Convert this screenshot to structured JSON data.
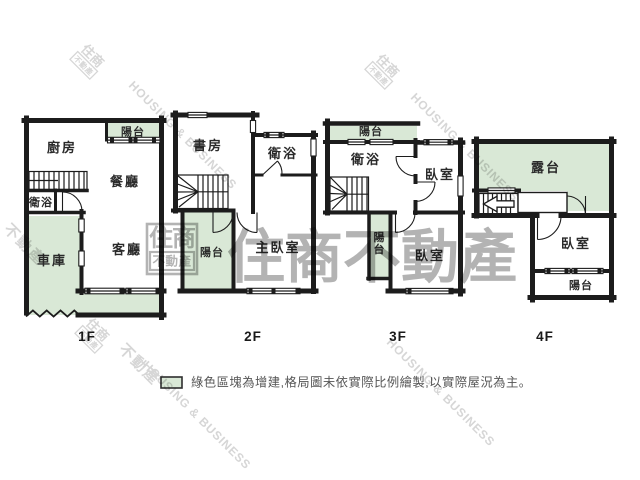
{
  "brand": {
    "logo_primary": "住商",
    "logo_secondary": "不動產",
    "name_cn": "住商不動產",
    "name_en": "HOUSING & BUSINESS"
  },
  "colors": {
    "addition_green": "#d9e8d6",
    "wall": "#1c1c1c",
    "watermark_center": "#b3b3b3",
    "watermark_diagonal": "#d6d6d6"
  },
  "floors": [
    {
      "label": "1F",
      "rooms": {
        "kitchen": "廚房",
        "balcony": "陽台",
        "dining": "餐廳",
        "bath": "衛浴",
        "living": "客廳",
        "garage": "車庫"
      }
    },
    {
      "label": "2F",
      "rooms": {
        "study": "書房",
        "bath": "衛浴",
        "balcony": "陽台",
        "master": "主臥室"
      }
    },
    {
      "label": "3F",
      "rooms": {
        "balcony_top": "陽台",
        "bath": "衛浴",
        "bedroom_top": "臥室",
        "balcony_mid": "陽台",
        "bedroom_bottom": "臥室"
      }
    },
    {
      "label": "4F",
      "rooms": {
        "terrace": "露台",
        "bedroom": "臥室",
        "balcony": "陽台"
      }
    }
  ],
  "legend": {
    "text": "綠色區塊為增建,格局圖未依實際比例繪製,以實際屋況為主。"
  }
}
